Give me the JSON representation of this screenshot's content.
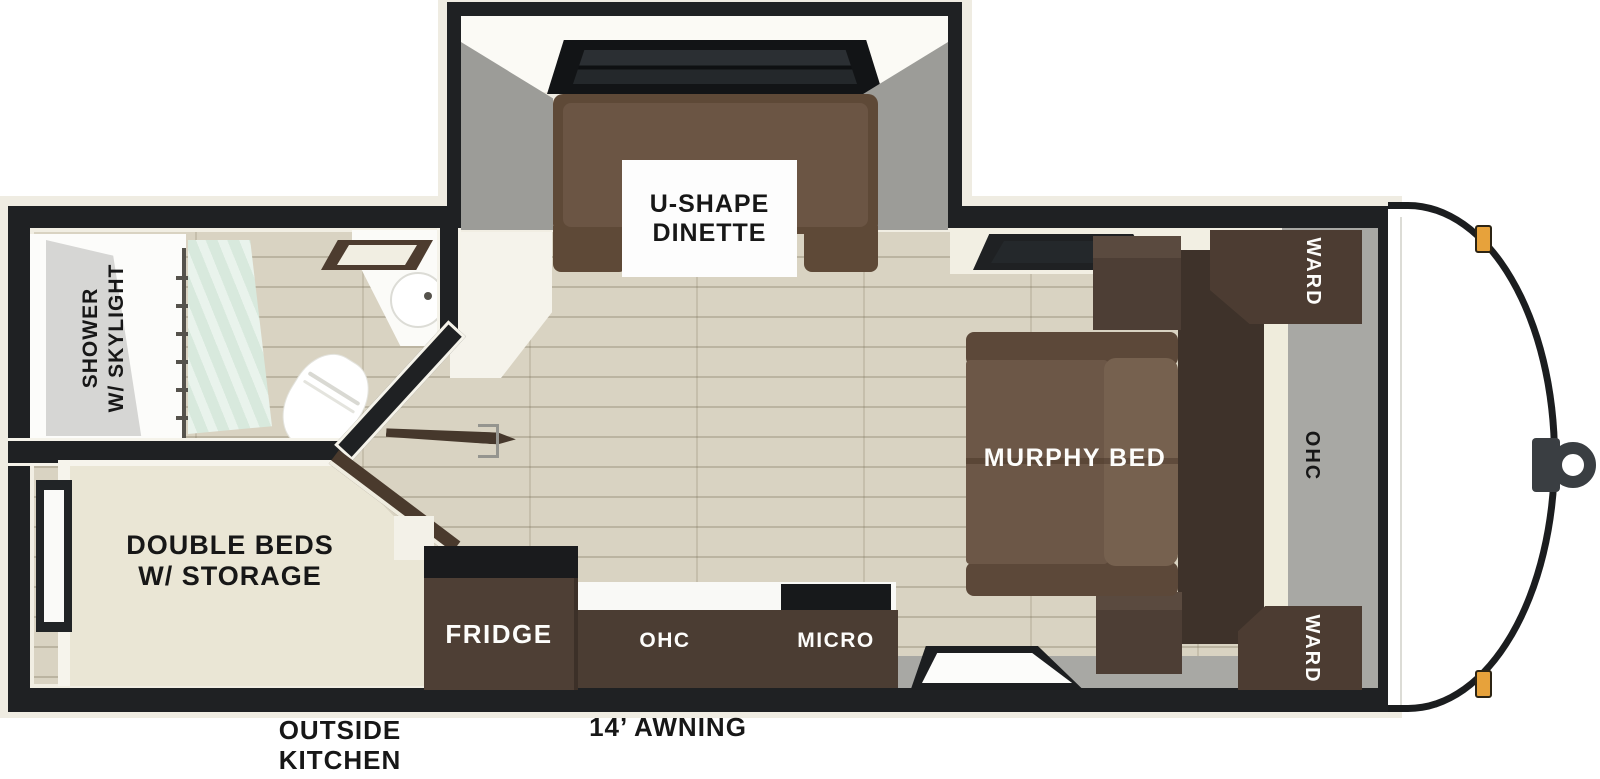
{
  "labels": {
    "dinette_line1": "U-SHAPE",
    "dinette_line2": "DINETTE",
    "shower_line1": "SHOWER",
    "shower_line2": "W/ SKYLIGHT",
    "double_beds_line1": "DOUBLE BEDS",
    "double_beds_line2": "W/ STORAGE",
    "murphy_bed": "MURPHY BED",
    "fridge": "FRIDGE",
    "kitchen_ohc": "OHC",
    "micro": "MICRO",
    "ward_top": "WARD",
    "bed_ohc": "OHC",
    "ward_bottom": "WARD",
    "outside_kitchen_line1": "OUTSIDE",
    "outside_kitchen_line2": "KITCHEN",
    "awning": "14’ AWNING"
  },
  "colors": {
    "wall": "#1f2123",
    "ext": "#efece2",
    "wood": "#d9d3c2",
    "gray": "#a8a8a4",
    "dark-cab": "#4b3d33",
    "panel": "#3e322a",
    "bench": "#5e4937",
    "bench-cushion": "#6b5544",
    "sofa": "#6c5747",
    "sofa-back": "#76614f",
    "armrest": "#5c4839",
    "cream-bed": "#eae6d5",
    "ivory": "#f2efe3",
    "mint": "#d8e9dd",
    "orange": "#e7a23b",
    "hitch": "#3a3e42"
  }
}
